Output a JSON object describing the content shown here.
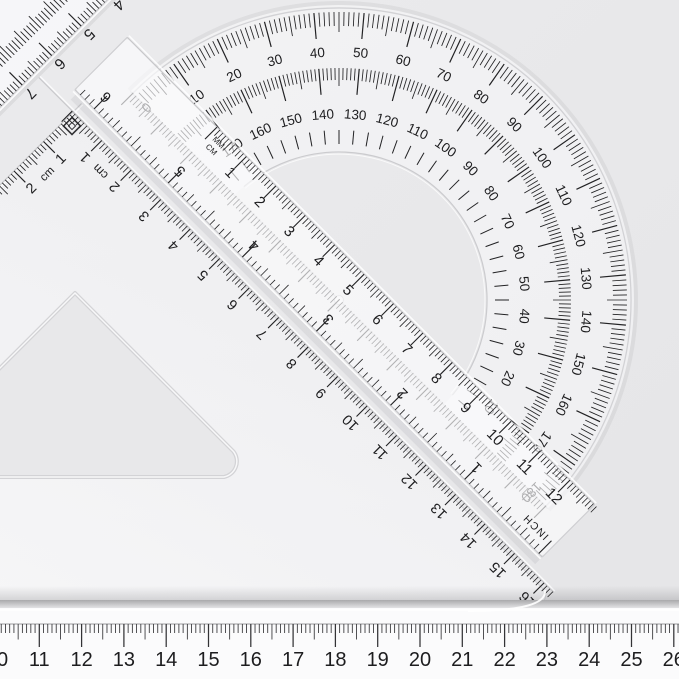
{
  "scene_description": "transparent-geometry-tools-photo",
  "colors": {
    "background": "#e8e8ea",
    "background_edge": "#e4e4e6",
    "ink": "#222224",
    "number_ink": "#1c1c1e",
    "plastic_edge": "#c9c9cc",
    "plastic_fill": "#fbfbfc",
    "groove": "#d3d3d6",
    "highlight": "#ffffff"
  },
  "protractor": {
    "outer_scale_labels": [
      "0",
      "10",
      "20",
      "30",
      "40",
      "50",
      "60",
      "70",
      "80",
      "90",
      "100",
      "110",
      "120",
      "130",
      "140",
      "150",
      "160",
      "170",
      "180"
    ],
    "inner_scale_labels": [
      "170",
      "160",
      "150",
      "140",
      "130",
      "120",
      "110",
      "100",
      "90",
      "80",
      "70",
      "60",
      "50",
      "40",
      "30",
      "20",
      "10"
    ]
  },
  "diagonal_ruler": {
    "unit_label_line1": "MM",
    "unit_label_line2": "CM",
    "cm_numbers": [
      "1",
      "2",
      "3",
      "4",
      "5",
      "6",
      "7",
      "8",
      "9",
      "10",
      "11",
      "12"
    ],
    "inch_numbers": [
      "1",
      "2",
      "3",
      "4",
      "5",
      "6"
    ],
    "inch_label": "INCH"
  },
  "set_square": {
    "hypotenuse_numbers": [
      "1",
      "2",
      "3",
      "4",
      "5",
      "6",
      "7",
      "8",
      "9",
      "10",
      "11",
      "12",
      "13",
      "14",
      "15",
      "16"
    ],
    "hypotenuse_unit": "cm",
    "left_edge_numbers": [
      "1",
      "2"
    ],
    "left_edge_unit": "cm"
  },
  "corner_ruler": {
    "numbers": [
      "4",
      "5",
      "6",
      "7"
    ]
  },
  "bottom_ruler": {
    "numbers": [
      "10",
      "11",
      "12",
      "13",
      "14",
      "15",
      "16",
      "17",
      "18",
      "19",
      "20",
      "21",
      "22",
      "23",
      "24",
      "25",
      "26"
    ]
  }
}
